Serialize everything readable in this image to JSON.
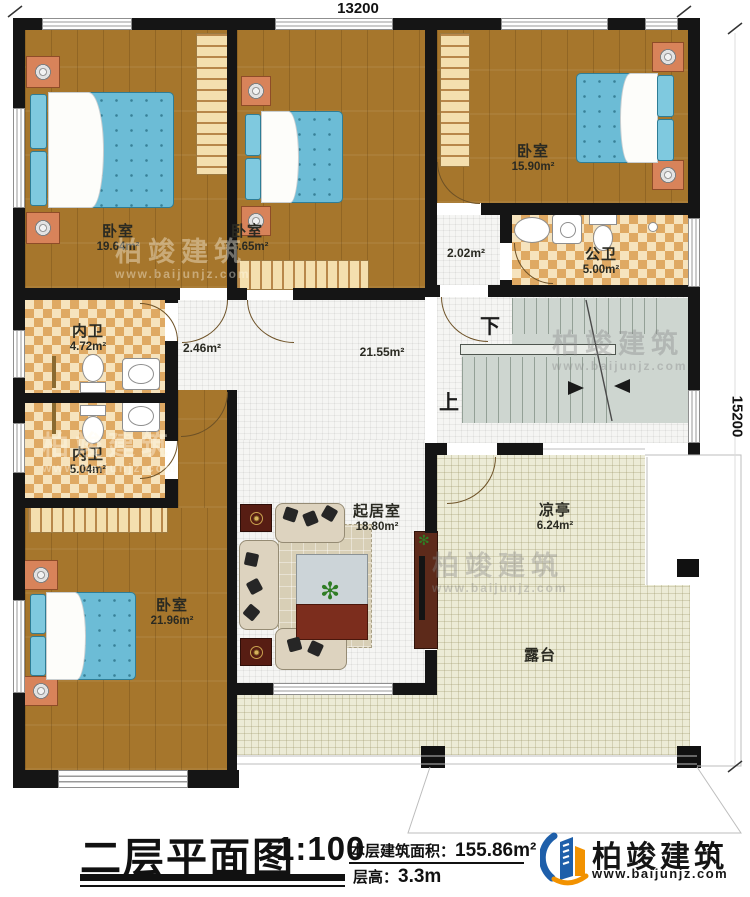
{
  "plan": {
    "dim_top": "13200",
    "dim_right": "15200"
  },
  "rooms": {
    "bedroom_tl": {
      "name": "卧室",
      "area": "19.64m²"
    },
    "bedroom_tm": {
      "name": "卧室",
      "area": "18.65m²"
    },
    "bedroom_tr": {
      "name": "卧室",
      "area": "15.90m²"
    },
    "public_bath": {
      "name": "公卫",
      "area": "5.00m²"
    },
    "ensuite_a": {
      "name": "内卫",
      "area": "4.72m²"
    },
    "ensuite_b": {
      "name": "内卫",
      "area": "5.04m²"
    },
    "bedroom_bl": {
      "name": "卧室",
      "area": "21.96m²"
    },
    "living": {
      "name": "起居室",
      "area": "18.80m²"
    },
    "pavilion": {
      "name": "凉亭",
      "area": "6.24m²"
    },
    "terrace": {
      "name": "露台"
    }
  },
  "halls": {
    "small": "2.02m²",
    "mid": "2.46m²",
    "main": "21.55m²"
  },
  "stairs": {
    "down": "下",
    "up": "上"
  },
  "title_block": {
    "title": "二层平面图",
    "scale": "1:100",
    "area_label": "本层建筑面积：",
    "area_value": "155.86m²",
    "floor_height_label": "层高：",
    "floor_height_value": "3.3m"
  },
  "brand": {
    "name": "柏竣建筑",
    "url": "www.baijunjz.com"
  },
  "watermark": {
    "name": "柏竣建筑",
    "url": "www.baijunjz.com"
  },
  "colors": {
    "wall": "#151515",
    "wood": "#a6762c",
    "tile": "#f5f5f3",
    "checker_tan": "#dfa963",
    "cream": "#ecebd6",
    "stair_grey": "#ced6d0",
    "bed_blue": "#6cbcd6",
    "brand_blue": "#1e5faa",
    "brand_orange": "#f29200"
  }
}
